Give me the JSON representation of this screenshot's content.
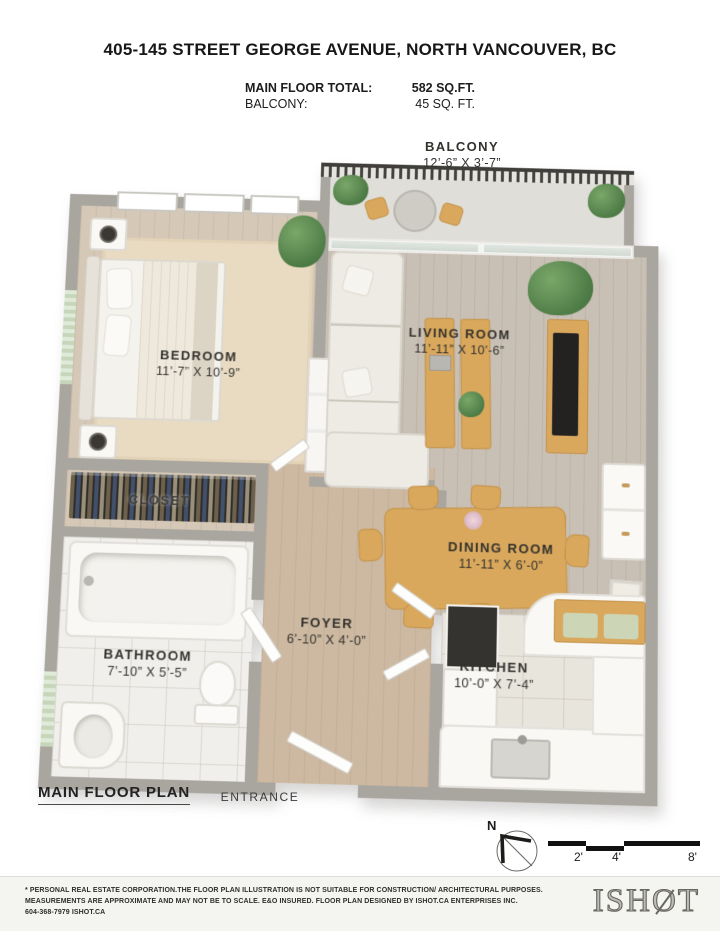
{
  "header": {
    "title": "405-145 STREET GEORGE AVENUE, NORTH VANCOUVER, BC",
    "summary": [
      {
        "label": "MAIN FLOOR TOTAL:",
        "value": "582 SQ.FT."
      },
      {
        "label": "BALCONY:",
        "value": "45 SQ. FT."
      }
    ]
  },
  "plan": {
    "title": "MAIN FLOOR PLAN",
    "entrance_label": "ENTRANCE",
    "compass_label": "N",
    "scale_ticks": [
      "2'",
      "4'",
      "8'"
    ],
    "rooms": [
      {
        "id": "balcony",
        "name": "BALCONY",
        "dims": "12’-6” X 3’-7”"
      },
      {
        "id": "living-room",
        "name": "LIVING ROOM",
        "dims": "11’-11” X 10’-6”"
      },
      {
        "id": "bedroom",
        "name": "BEDROOM",
        "dims": "11’-7” X 10’-9”"
      },
      {
        "id": "dining-room",
        "name": "DINING ROOM",
        "dims": "11’-11” X 6’-0”"
      },
      {
        "id": "closet",
        "name": "CLOSET",
        "dims": ""
      },
      {
        "id": "bathroom",
        "name": "BATHROOM",
        "dims": "7’-10” X 5’-5”"
      },
      {
        "id": "foyer",
        "name": "FOYER",
        "dims": "6’-10” X 4’-0”"
      },
      {
        "id": "kitchen",
        "name": "KITCHEN",
        "dims": "10’-0” X 7’-4”"
      }
    ]
  },
  "footer": {
    "disclaimer_line1": "* PERSONAL REAL ESTATE CORPORATION.THE FLOOR PLAN ILLUSTRATION IS NOT SUITABLE FOR CONSTRUCTION/ ARCHITECTURAL PURPOSES.",
    "disclaimer_line2": "MEASUREMENTS ARE APPROXIMATE AND MAY NOT BE TO SCALE. E&O INSURED. FLOOR PLAN DESIGNED BY ISHOT.CA ENTERPRISES INC.",
    "contact": "604-368-7979  ISHOT.CA",
    "logo_prefix": "ISH",
    "logo_o": "O",
    "logo_suffix": "T"
  },
  "colors": {
    "wall": "#a9a6a0",
    "wood_floor": "#d5c8b6",
    "tile_floor": "#e8e5dc",
    "furniture_wood": "#d9a85c",
    "plant_green": "#53814a",
    "railing_dark": "#403e3a",
    "label_text": "#34322e"
  }
}
